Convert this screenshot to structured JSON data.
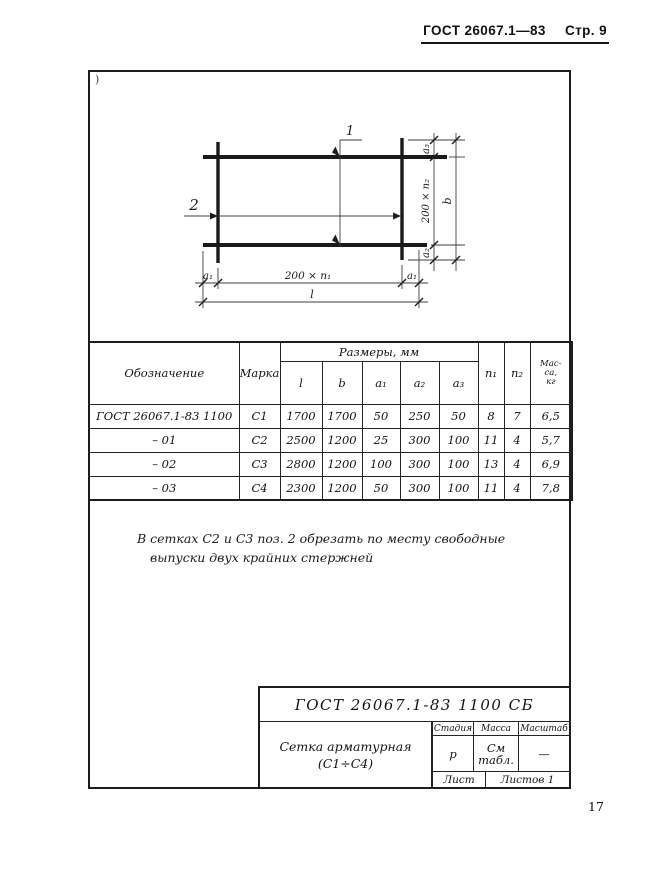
{
  "header": {
    "gost": "ГОСТ 26067.1—83",
    "page": "Стр. 9"
  },
  "corner_mark": ")",
  "drawing": {
    "pos1": "1",
    "pos2": "2",
    "dim_a1_left": "a₁",
    "dim_span_h": "200 × n₁",
    "dim_a1_right": "a₁",
    "dim_l": "l",
    "dim_a3": "a₃",
    "dim_span_v": "200 × n₂",
    "dim_a2": "a₂",
    "dim_b": "b"
  },
  "table": {
    "col_designation": "Обозначение",
    "col_mark": "Марка",
    "col_sizes": "Размеры, мм",
    "size_cols": [
      "l",
      "b",
      "a₁",
      "a₂",
      "a₃"
    ],
    "col_n1": "n₁",
    "col_n2": "n₂",
    "col_mass_lines": [
      "Мас-",
      "са,",
      "кг"
    ],
    "rows": [
      {
        "designation": "ГОСТ 26067.1-83 1100",
        "mark": "С1",
        "l": "1700",
        "b": "1700",
        "a1": "50",
        "a2": "250",
        "a3": "50",
        "n1": "8",
        "n2": "7",
        "mass": "6,5"
      },
      {
        "designation": "– 01",
        "mark": "С2",
        "l": "2500",
        "b": "1200",
        "a1": "25",
        "a2": "300",
        "a3": "100",
        "n1": "11",
        "n2": "4",
        "mass": "5,7"
      },
      {
        "designation": "– 02",
        "mark": "С3",
        "l": "2800",
        "b": "1200",
        "a1": "100",
        "a2": "300",
        "a3": "100",
        "n1": "13",
        "n2": "4",
        "mass": "6,9"
      },
      {
        "designation": "– 03",
        "mark": "С4",
        "l": "2300",
        "b": "1200",
        "a1": "50",
        "a2": "300",
        "a3": "100",
        "n1": "11",
        "n2": "4",
        "mass": "7,8"
      }
    ]
  },
  "note": {
    "line1": "В сетках С2 и С3 поз. 2 обрезать по месту свободные",
    "line2": "выпуски двух крайних стержней"
  },
  "title_block": {
    "doc": "ГОСТ 26067.1-83  1100 СБ",
    "name1": "Сетка арматурная",
    "name2": "(С1÷С4)",
    "stage_label": "Стадия",
    "mass_label": "Масса",
    "scale_label": "Масштаб",
    "stage": "р",
    "mass1": "См",
    "mass2": "табл.",
    "scale": "—",
    "sheet_label": "Лист",
    "sheets_label": "Листов 1"
  },
  "page_number": "17"
}
